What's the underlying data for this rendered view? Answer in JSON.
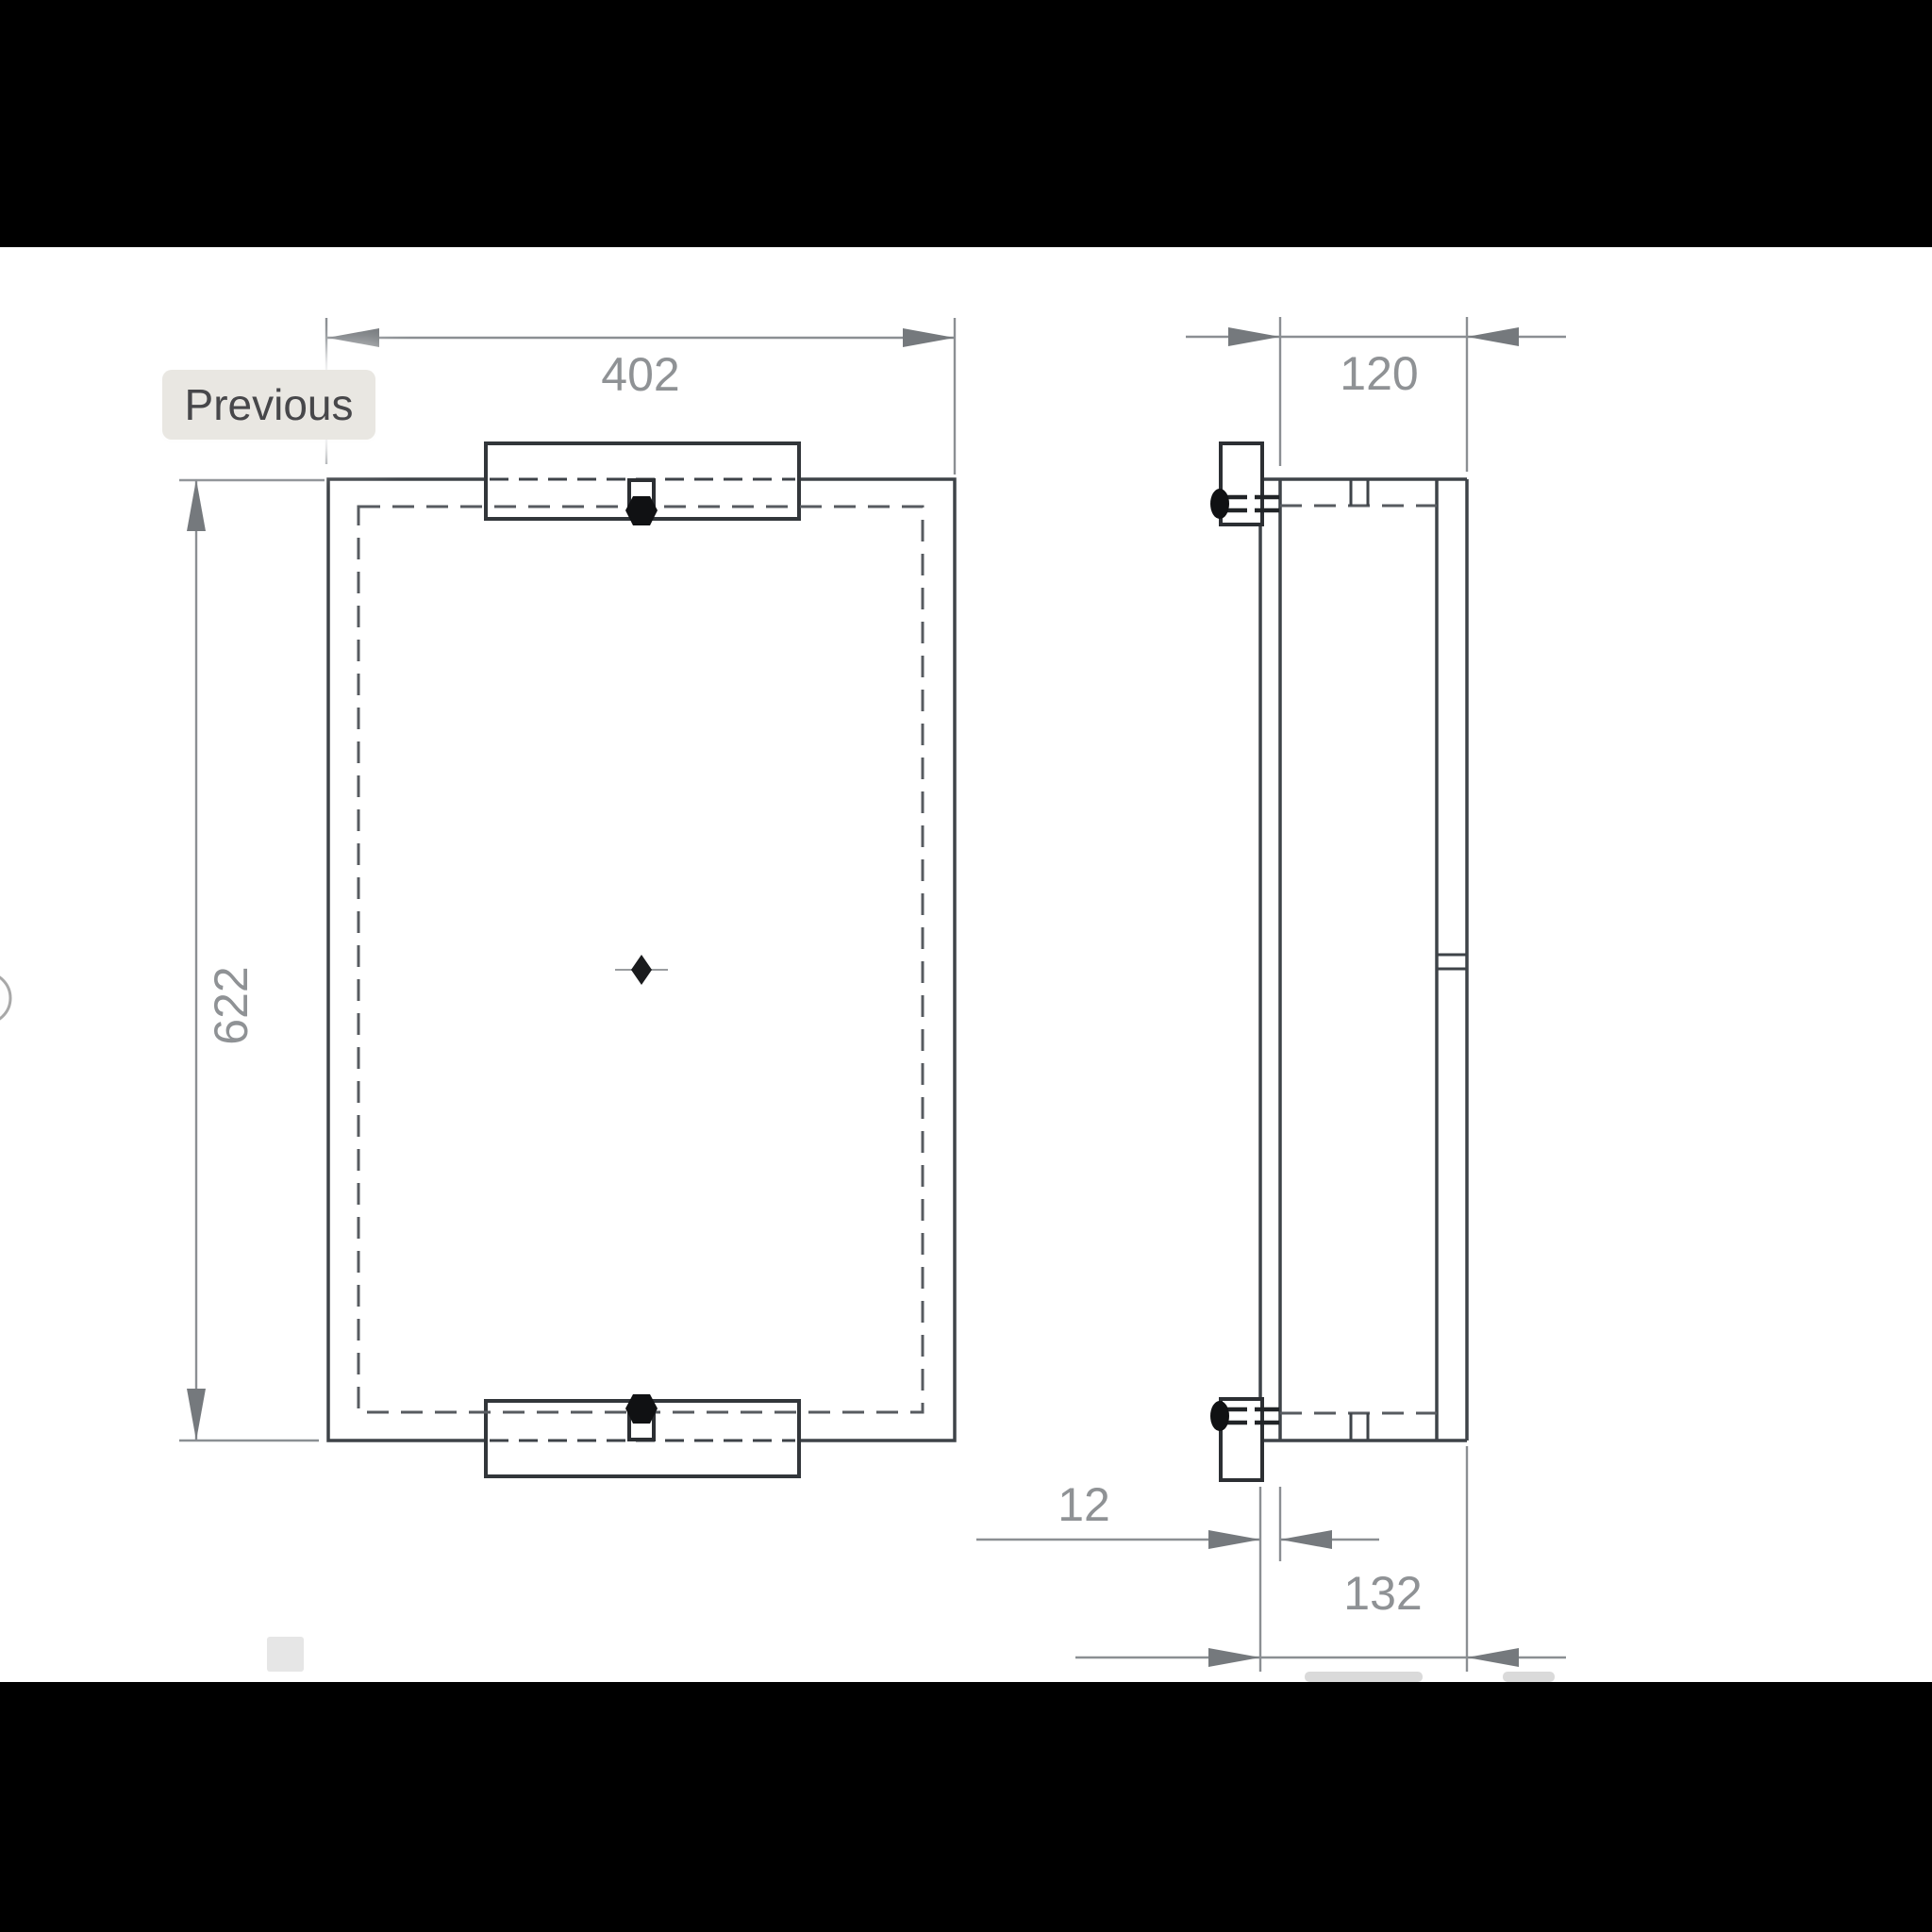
{
  "lightbox": {
    "previous_button": "Previous",
    "colors": {
      "letterbox": "#000000",
      "canvas": "#ffffff",
      "button_bg": "#e9e7e2",
      "button_text": "#47474a"
    }
  },
  "drawing": {
    "dimensions": {
      "front_width": "402",
      "front_height": "622",
      "side_inner_depth": "120",
      "side_plate_thickness": "12",
      "side_total_depth": "132"
    },
    "colors": {
      "outline": "#3e4348",
      "hidden_line": "#575b60",
      "dimension_line": "#8b8f93",
      "dimension_arrow": "#75797d",
      "dimension_text": "#8f9295",
      "screw": "#101113"
    }
  }
}
